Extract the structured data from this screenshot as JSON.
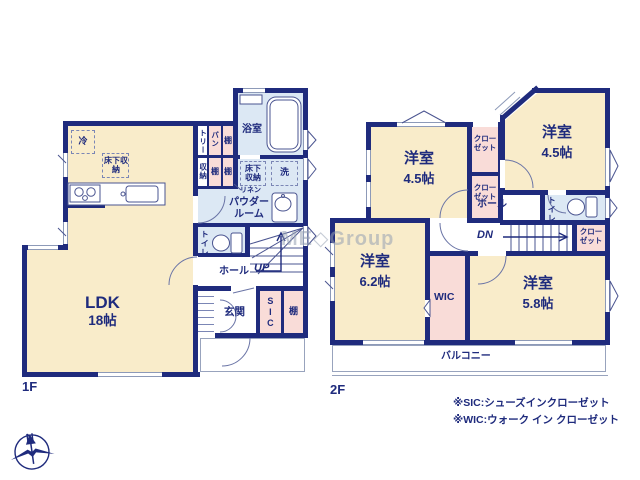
{
  "watermark": "ME◇Group",
  "compass": {
    "north": "N"
  },
  "colors": {
    "wall": "#1f2b7d",
    "room": "#f9ecca",
    "closet": "#f9dcd8",
    "wet_area": "#dce8f4",
    "text": "#1f2b7d"
  },
  "floor1": {
    "floor_label": "1F",
    "ldk_name": "LDK",
    "ldk_size": "18帖",
    "fridge": "冷",
    "underfloor_storage_kitchen": "床下収納",
    "pantry_col_left": "トリー",
    "pantry_col_right": "パン",
    "pantry_shelf": "棚",
    "storage": "収納",
    "shelf_a": "棚",
    "shelf_b": "棚",
    "bathroom": "浴室",
    "underfloor_storage_wash": "床下収納",
    "washer": "洗",
    "linen": "リネン",
    "powder_room": "パウダールーム",
    "toilet": "トイレ",
    "hall": "ホール",
    "stairs_dir": "UP",
    "entrance": "玄関",
    "sic": "SIC",
    "entrance_shelf": "棚"
  },
  "floor2": {
    "floor_label": "2F",
    "room_nw_name": "洋室",
    "room_nw_size": "4.5帖",
    "room_ne_name": "洋室",
    "room_ne_size": "4.5帖",
    "room_sw_name": "洋室",
    "room_sw_size": "6.2帖",
    "room_se_name": "洋室",
    "room_se_size": "5.8帖",
    "closet_a": "クローゼット",
    "closet_b": "クローゼット",
    "closet_c": "クローゼット",
    "toilet": "トイレ",
    "hall": "ホール",
    "stairs_dir": "DN",
    "wic": "WIC",
    "balcony": "バルコニー"
  },
  "notes": {
    "sic": "※SIC:シューズインクローゼット",
    "wic": "※WIC:ウォーク イン クローゼット"
  }
}
